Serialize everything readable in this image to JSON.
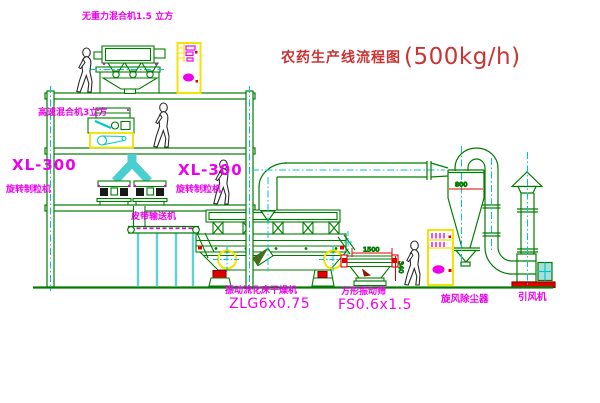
{
  "title": {
    "name": "农药生产线流程图",
    "capacity": "(500kg/h)"
  },
  "labels": {
    "mixer_top": "无重力混合机1.5 立方",
    "high_speed_mixer": "高速混合机3立方",
    "granulator_left_model": "XL-300",
    "granulator_left_name": "旋转制粒机",
    "granulator_right_model": "XL-300",
    "granulator_right_name": "旋转制粒机",
    "belt_conveyor": "皮带输送机",
    "dryer_name": "振动流化床干燥机",
    "dryer_model": "ZLG6x0.75",
    "sieve_name": "方形振动筛",
    "sieve_model": "FS0.6x1.5",
    "cyclone_name": "旋风除尘器",
    "fan_name": "引风机"
  },
  "dimensions": {
    "sieve_length": "1500",
    "cyclone_diameter": "800",
    "sieve_height": "340"
  },
  "colors": {
    "line_green": "#007d00",
    "centerline_cyan": "#00c8c8",
    "label_magenta": "#ee00ee",
    "accent_yellow": "#f0e400",
    "dimension_red": "#e00000",
    "title_red": "#cc3333"
  }
}
